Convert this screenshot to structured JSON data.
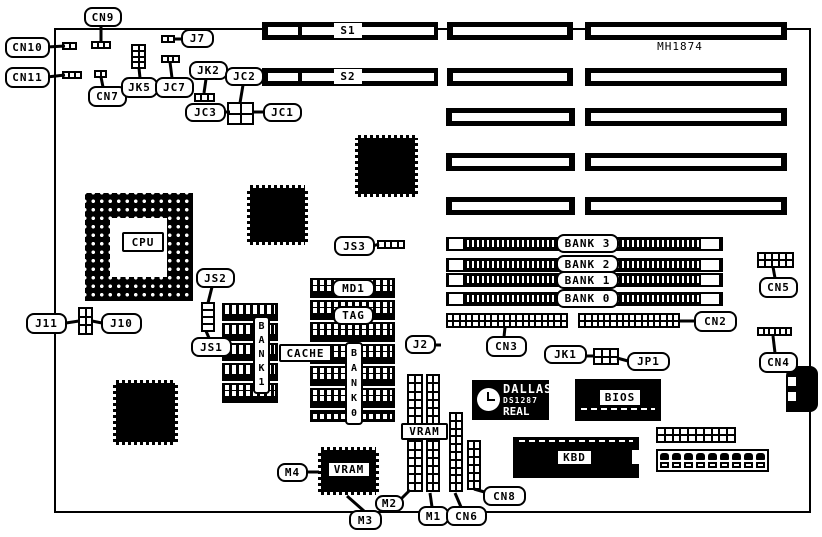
{
  "title": "MH1874",
  "colors": {
    "ink": "#000000",
    "paper": "#ffffff"
  },
  "board_outline": {
    "rect": [
      54,
      28,
      757,
      485
    ]
  },
  "title_pos": [
    648,
    40,
    64,
    14
  ],
  "dallas_chip": {
    "rect": [
      472,
      380,
      77,
      40
    ],
    "line1": "DALLAS",
    "line2": "DS1287",
    "line3": "REAL TIME"
  },
  "bios_chip": {
    "rect": [
      575,
      379,
      86,
      42
    ],
    "dash": [
      6,
      29,
      74
    ]
  },
  "kbd_chip": {
    "rect": [
      513,
      437,
      126,
      41
    ],
    "dash": [
      6,
      3,
      114
    ],
    "notch": [
      119,
      13,
      7,
      14
    ]
  },
  "keyboard_connector": {
    "rect": [
      786,
      366,
      32,
      46
    ],
    "notches": [
      [
        2,
        11,
        8,
        9
      ],
      [
        2,
        26,
        8,
        9
      ]
    ]
  },
  "terminal_block": {
    "rect": [
      656,
      449,
      113,
      23
    ],
    "cells": 9
  },
  "cpu_socket": {
    "rect": [
      85,
      193,
      108,
      108
    ],
    "center": [
      25,
      25,
      57,
      59
    ]
  },
  "labels": [
    {
      "id": "cn9",
      "text": "CN9",
      "rect": [
        84,
        7,
        38,
        20
      ],
      "line": [
        101,
        26,
        101,
        42
      ]
    },
    {
      "id": "cn10",
      "text": "CN10",
      "rect": [
        5,
        37,
        45,
        21
      ],
      "line": [
        47,
        47,
        65,
        46
      ]
    },
    {
      "id": "cn11",
      "text": "CN11",
      "rect": [
        5,
        67,
        45,
        21
      ],
      "line": [
        47,
        77,
        65,
        75
      ]
    },
    {
      "id": "cn7",
      "text": "CN7",
      "rect": [
        88,
        86,
        39,
        21
      ],
      "line": [
        103,
        87,
        101,
        77
      ]
    },
    {
      "id": "jk5",
      "text": "JK5",
      "rect": [
        121,
        77,
        37,
        21
      ],
      "line": [
        140,
        78,
        139,
        68
      ]
    },
    {
      "id": "jc7",
      "text": "JC7",
      "rect": [
        155,
        77,
        39,
        21
      ],
      "line": [
        172,
        78,
        170,
        62
      ]
    },
    {
      "id": "j7",
      "text": "J7",
      "rect": [
        181,
        29,
        33,
        19
      ],
      "line": [
        182,
        39,
        174,
        39
      ]
    },
    {
      "id": "jk2",
      "text": "JK2",
      "rect": [
        189,
        61,
        39,
        19
      ],
      "line": [
        206,
        79,
        204,
        93
      ]
    },
    {
      "id": "jc2",
      "text": "JC2",
      "rect": [
        225,
        67,
        39,
        19
      ],
      "line": [
        243,
        85,
        240,
        103
      ]
    },
    {
      "id": "jc3",
      "text": "JC3",
      "rect": [
        185,
        103,
        41,
        19
      ],
      "line": [
        222,
        112,
        230,
        112
      ]
    },
    {
      "id": "jc1",
      "text": "JC1",
      "rect": [
        263,
        103,
        39,
        19
      ],
      "line": [
        252,
        112,
        264,
        112
      ]
    },
    {
      "id": "s1",
      "text": "S1",
      "rect": [
        334,
        23,
        28,
        15
      ],
      "kind": "plain"
    },
    {
      "id": "s2",
      "text": "S2",
      "rect": [
        334,
        69,
        28,
        15
      ],
      "kind": "plain"
    },
    {
      "id": "cpu",
      "text": "CPU",
      "rect": [
        122,
        232,
        42,
        20
      ],
      "kind": "boxed"
    },
    {
      "id": "js3",
      "text": "JS3",
      "rect": [
        334,
        236,
        41,
        20
      ],
      "line": [
        373,
        246,
        379,
        244
      ]
    },
    {
      "id": "j11",
      "text": "J11",
      "rect": [
        26,
        313,
        41,
        21
      ],
      "line": [
        66,
        323,
        79,
        321
      ]
    },
    {
      "id": "j10",
      "text": "J10",
      "rect": [
        101,
        313,
        41,
        21
      ],
      "line": [
        102,
        323,
        92,
        321
      ]
    },
    {
      "id": "js2",
      "text": "JS2",
      "rect": [
        196,
        268,
        39,
        20
      ],
      "line": [
        212,
        287,
        208,
        303
      ]
    },
    {
      "id": "js1",
      "text": "JS1",
      "rect": [
        191,
        337,
        41,
        20
      ],
      "line": [
        209,
        338,
        206,
        331
      ]
    },
    {
      "id": "md1",
      "text": "MD1",
      "rect": [
        332,
        279,
        43,
        19
      ]
    },
    {
      "id": "tag",
      "text": "TAG",
      "rect": [
        333,
        306,
        41,
        19
      ]
    },
    {
      "id": "cache",
      "text": "CACHE",
      "rect": [
        279,
        344,
        53,
        18
      ],
      "kind": "boxed"
    },
    {
      "id": "bank1-cache",
      "text": "BANK1",
      "rect": [
        253,
        316,
        17,
        78
      ],
      "kind": "vertical"
    },
    {
      "id": "bank0-cache",
      "text": "BANK0",
      "rect": [
        345,
        342,
        18,
        83
      ],
      "kind": "vertical"
    },
    {
      "id": "bank3-simm",
      "text": "BANK 3",
      "rect": [
        556,
        234,
        63,
        19
      ]
    },
    {
      "id": "bank2-simm",
      "text": "BANK 2",
      "rect": [
        556,
        255,
        63,
        18
      ]
    },
    {
      "id": "bank1-simm",
      "text": "BANK 1",
      "rect": [
        556,
        271,
        63,
        18
      ]
    },
    {
      "id": "bank0-simm",
      "text": "BANK 0",
      "rect": [
        556,
        289,
        63,
        19
      ]
    },
    {
      "id": "cn5",
      "text": "CN5",
      "rect": [
        759,
        277,
        39,
        21
      ],
      "line": [
        775,
        278,
        773,
        267
      ]
    },
    {
      "id": "cn2",
      "text": "CN2",
      "rect": [
        694,
        311,
        43,
        21
      ],
      "line": [
        695,
        321,
        680,
        321
      ]
    },
    {
      "id": "cn4",
      "text": "CN4",
      "rect": [
        759,
        352,
        39,
        21
      ],
      "line": [
        775,
        353,
        773,
        336
      ]
    },
    {
      "id": "cn3",
      "text": "CN3",
      "rect": [
        486,
        336,
        41,
        21
      ],
      "line": [
        504,
        337,
        505,
        327
      ]
    },
    {
      "id": "j2",
      "text": "J2",
      "rect": [
        405,
        335,
        31,
        19
      ],
      "line": [
        435,
        345,
        441,
        345
      ]
    },
    {
      "id": "jk1",
      "text": "JK1",
      "rect": [
        544,
        345,
        43,
        19
      ],
      "line": [
        586,
        356,
        594,
        356
      ]
    },
    {
      "id": "jp1",
      "text": "JP1",
      "rect": [
        627,
        352,
        43,
        19
      ],
      "line": [
        628,
        361,
        617,
        358
      ]
    },
    {
      "id": "bios",
      "text": "BIOS",
      "rect": [
        598,
        388,
        44,
        19
      ],
      "kind": "boxed"
    },
    {
      "id": "vram-modules",
      "text": "VRAM",
      "rect": [
        401,
        423,
        47,
        17
      ],
      "kind": "boxed"
    },
    {
      "id": "vram-chip",
      "text": "VRAM",
      "rect": [
        327,
        461,
        44,
        17
      ],
      "kind": "boxed"
    },
    {
      "id": "kbd",
      "text": "KBD",
      "rect": [
        556,
        449,
        37,
        17
      ],
      "kind": "boxed"
    },
    {
      "id": "m4",
      "text": "M4",
      "rect": [
        277,
        463,
        31,
        19
      ],
      "line": [
        307,
        472,
        319,
        472
      ]
    },
    {
      "id": "m3",
      "text": "M3",
      "rect": [
        349,
        510,
        33,
        20
      ],
      "line": [
        364,
        511,
        347,
        496
      ]
    },
    {
      "id": "m2",
      "text": "M2",
      "rect": [
        375,
        495,
        29,
        17
      ],
      "line": [
        401,
        499,
        410,
        490
      ]
    },
    {
      "id": "m1",
      "text": "M1",
      "rect": [
        418,
        506,
        31,
        20
      ],
      "line": [
        432,
        507,
        430,
        493
      ]
    },
    {
      "id": "cn6",
      "text": "CN6",
      "rect": [
        446,
        506,
        41,
        20
      ],
      "line": [
        461,
        507,
        455,
        493
      ]
    },
    {
      "id": "cn8",
      "text": "CN8",
      "rect": [
        483,
        486,
        43,
        20
      ],
      "line": [
        488,
        493,
        474,
        489
      ]
    }
  ],
  "pin_headers": [
    {
      "name": "cn9-connector",
      "rect": [
        91,
        41,
        20,
        8
      ],
      "cols": 3,
      "rows": 1
    },
    {
      "name": "cn10-connector",
      "rect": [
        62,
        42,
        15,
        8
      ],
      "cols": 2,
      "rows": 1
    },
    {
      "name": "cn11-connector",
      "rect": [
        62,
        71,
        20,
        8
      ],
      "cols": 3,
      "rows": 1
    },
    {
      "name": "cn7-connector",
      "rect": [
        94,
        70,
        13,
        8
      ],
      "cols": 2,
      "rows": 1
    },
    {
      "name": "jk5-jumper",
      "rect": [
        131,
        44,
        15,
        25
      ],
      "cols": 2,
      "rows": 4
    },
    {
      "name": "jc7-connector",
      "rect": [
        161,
        55,
        19,
        8
      ],
      "cols": 3,
      "rows": 1
    },
    {
      "name": "j7-connector",
      "rect": [
        161,
        35,
        14,
        8
      ],
      "cols": 2,
      "rows": 1
    },
    {
      "name": "jk2-jumper",
      "rect": [
        194,
        93,
        21,
        9
      ],
      "cols": 3,
      "rows": 1
    },
    {
      "name": "jc1-jc2-jc3-jumper",
      "rect": [
        227,
        102,
        27,
        23
      ],
      "cols": 2,
      "rows": 2
    },
    {
      "name": "j10-j11-jumper",
      "rect": [
        78,
        307,
        15,
        28
      ],
      "cols": 2,
      "rows": 3
    },
    {
      "name": "js1-js2-jumper",
      "rect": [
        201,
        302,
        14,
        30
      ],
      "cols": 1,
      "rows": 4
    },
    {
      "name": "js3-connector",
      "rect": [
        377,
        240,
        28,
        9
      ],
      "cols": 4,
      "rows": 1
    },
    {
      "name": "cn5-header",
      "rect": [
        757,
        252,
        37,
        16
      ],
      "cols": 5,
      "rows": 2
    },
    {
      "name": "cn2-header",
      "rect": [
        578,
        313,
        102,
        15
      ],
      "cols": 16,
      "rows": 2
    },
    {
      "name": "cn3-header",
      "rect": [
        446,
        313,
        122,
        15
      ],
      "cols": 19,
      "rows": 2
    },
    {
      "name": "cn4-header",
      "rect": [
        757,
        327,
        35,
        9
      ],
      "cols": 6,
      "rows": 1
    },
    {
      "name": "jk1-jumper",
      "rect": [
        593,
        348,
        26,
        17
      ],
      "cols": 3,
      "rows": 2
    },
    {
      "name": "cn1-header",
      "rect": [
        656,
        427,
        80,
        16
      ],
      "cols": 10,
      "rows": 2
    },
    {
      "name": "m2-module",
      "rect": [
        407,
        374,
        16,
        118
      ],
      "cols": 2,
      "rows": 14
    },
    {
      "name": "m1-module",
      "rect": [
        426,
        374,
        14,
        118
      ],
      "cols": 2,
      "rows": 14
    },
    {
      "name": "cn6-connector",
      "rect": [
        449,
        412,
        14,
        80
      ],
      "cols": 2,
      "rows": 10
    },
    {
      "name": "cn8-connector",
      "rect": [
        467,
        440,
        14,
        50
      ],
      "cols": 2,
      "rows": 6
    }
  ],
  "cache_sockets": [
    {
      "rect": [
        222,
        303,
        56,
        18
      ]
    },
    {
      "rect": [
        222,
        323,
        56,
        18
      ]
    },
    {
      "rect": [
        222,
        343,
        56,
        18
      ]
    },
    {
      "rect": [
        222,
        363,
        56,
        18
      ]
    },
    {
      "rect": [
        222,
        383,
        56,
        20
      ]
    },
    {
      "rect": [
        310,
        278,
        85,
        20
      ]
    },
    {
      "rect": [
        310,
        300,
        85,
        20
      ]
    },
    {
      "rect": [
        310,
        322,
        85,
        20
      ]
    },
    {
      "rect": [
        310,
        344,
        85,
        20
      ]
    },
    {
      "rect": [
        310,
        366,
        85,
        20
      ]
    },
    {
      "rect": [
        310,
        388,
        85,
        20
      ]
    },
    {
      "rect": [
        310,
        410,
        85,
        12
      ],
      "single": true
    }
  ],
  "qfp_chips": [
    {
      "name": "chip-qfp-upper",
      "rect": [
        355,
        135,
        63,
        62
      ]
    },
    {
      "name": "chip-qfp-middle",
      "rect": [
        247,
        185,
        61,
        60
      ]
    },
    {
      "name": "chip-qfp-lower-left",
      "rect": [
        113,
        380,
        65,
        65
      ]
    },
    {
      "name": "vram-chip-qfp",
      "rect": [
        318,
        447,
        61,
        48
      ]
    }
  ],
  "expansion_slots": [
    {
      "name": "slot-s1",
      "rect": [
        262,
        22,
        176,
        18
      ],
      "slots": [
        [
          6,
          5,
          30,
          8
        ],
        [
          40,
          5,
          132,
          8
        ]
      ]
    },
    {
      "name": "slot-s2",
      "rect": [
        262,
        68,
        176,
        18
      ],
      "slots": [
        [
          6,
          5,
          30,
          8
        ],
        [
          40,
          5,
          132,
          8
        ]
      ]
    },
    {
      "name": "slot-seg",
      "rect": [
        447,
        22,
        126,
        18
      ],
      "slots": [
        [
          6,
          5,
          114,
          8
        ]
      ]
    },
    {
      "name": "slot-seg",
      "rect": [
        585,
        22,
        202,
        18
      ],
      "slots": [
        [
          6,
          5,
          190,
          8
        ]
      ]
    },
    {
      "name": "slot-seg",
      "rect": [
        447,
        68,
        126,
        18
      ],
      "slots": [
        [
          6,
          5,
          114,
          8
        ]
      ]
    },
    {
      "name": "slot-seg",
      "rect": [
        585,
        68,
        202,
        18
      ],
      "slots": [
        [
          6,
          5,
          190,
          8
        ]
      ]
    },
    {
      "name": "slot-seg",
      "rect": [
        446,
        108,
        129,
        18
      ],
      "slots": [
        [
          6,
          5,
          117,
          8
        ]
      ]
    },
    {
      "name": "slot-seg",
      "rect": [
        585,
        108,
        202,
        18
      ],
      "slots": [
        [
          6,
          5,
          190,
          8
        ]
      ]
    },
    {
      "name": "slot-seg",
      "rect": [
        446,
        153,
        129,
        18
      ],
      "slots": [
        [
          6,
          5,
          117,
          8
        ]
      ]
    },
    {
      "name": "slot-seg",
      "rect": [
        585,
        153,
        202,
        18
      ],
      "slots": [
        [
          6,
          5,
          190,
          8
        ]
      ]
    },
    {
      "name": "slot-seg",
      "rect": [
        446,
        197,
        129,
        18
      ],
      "slots": [
        [
          6,
          5,
          117,
          8
        ]
      ]
    },
    {
      "name": "slot-seg",
      "rect": [
        585,
        197,
        202,
        18
      ],
      "slots": [
        [
          6,
          5,
          190,
          8
        ]
      ]
    }
  ],
  "simm_banks": [
    {
      "id": "bank3",
      "y": 237
    },
    {
      "id": "bank2",
      "y": 258
    },
    {
      "id": "bank1",
      "y": 273
    },
    {
      "id": "bank0",
      "y": 292
    }
  ],
  "simm_geometry": {
    "x": 446,
    "width": 277,
    "height": 14,
    "latch_left": [
      447,
      18,
      14
    ],
    "latch_right": [
      699,
      22,
      14
    ]
  }
}
